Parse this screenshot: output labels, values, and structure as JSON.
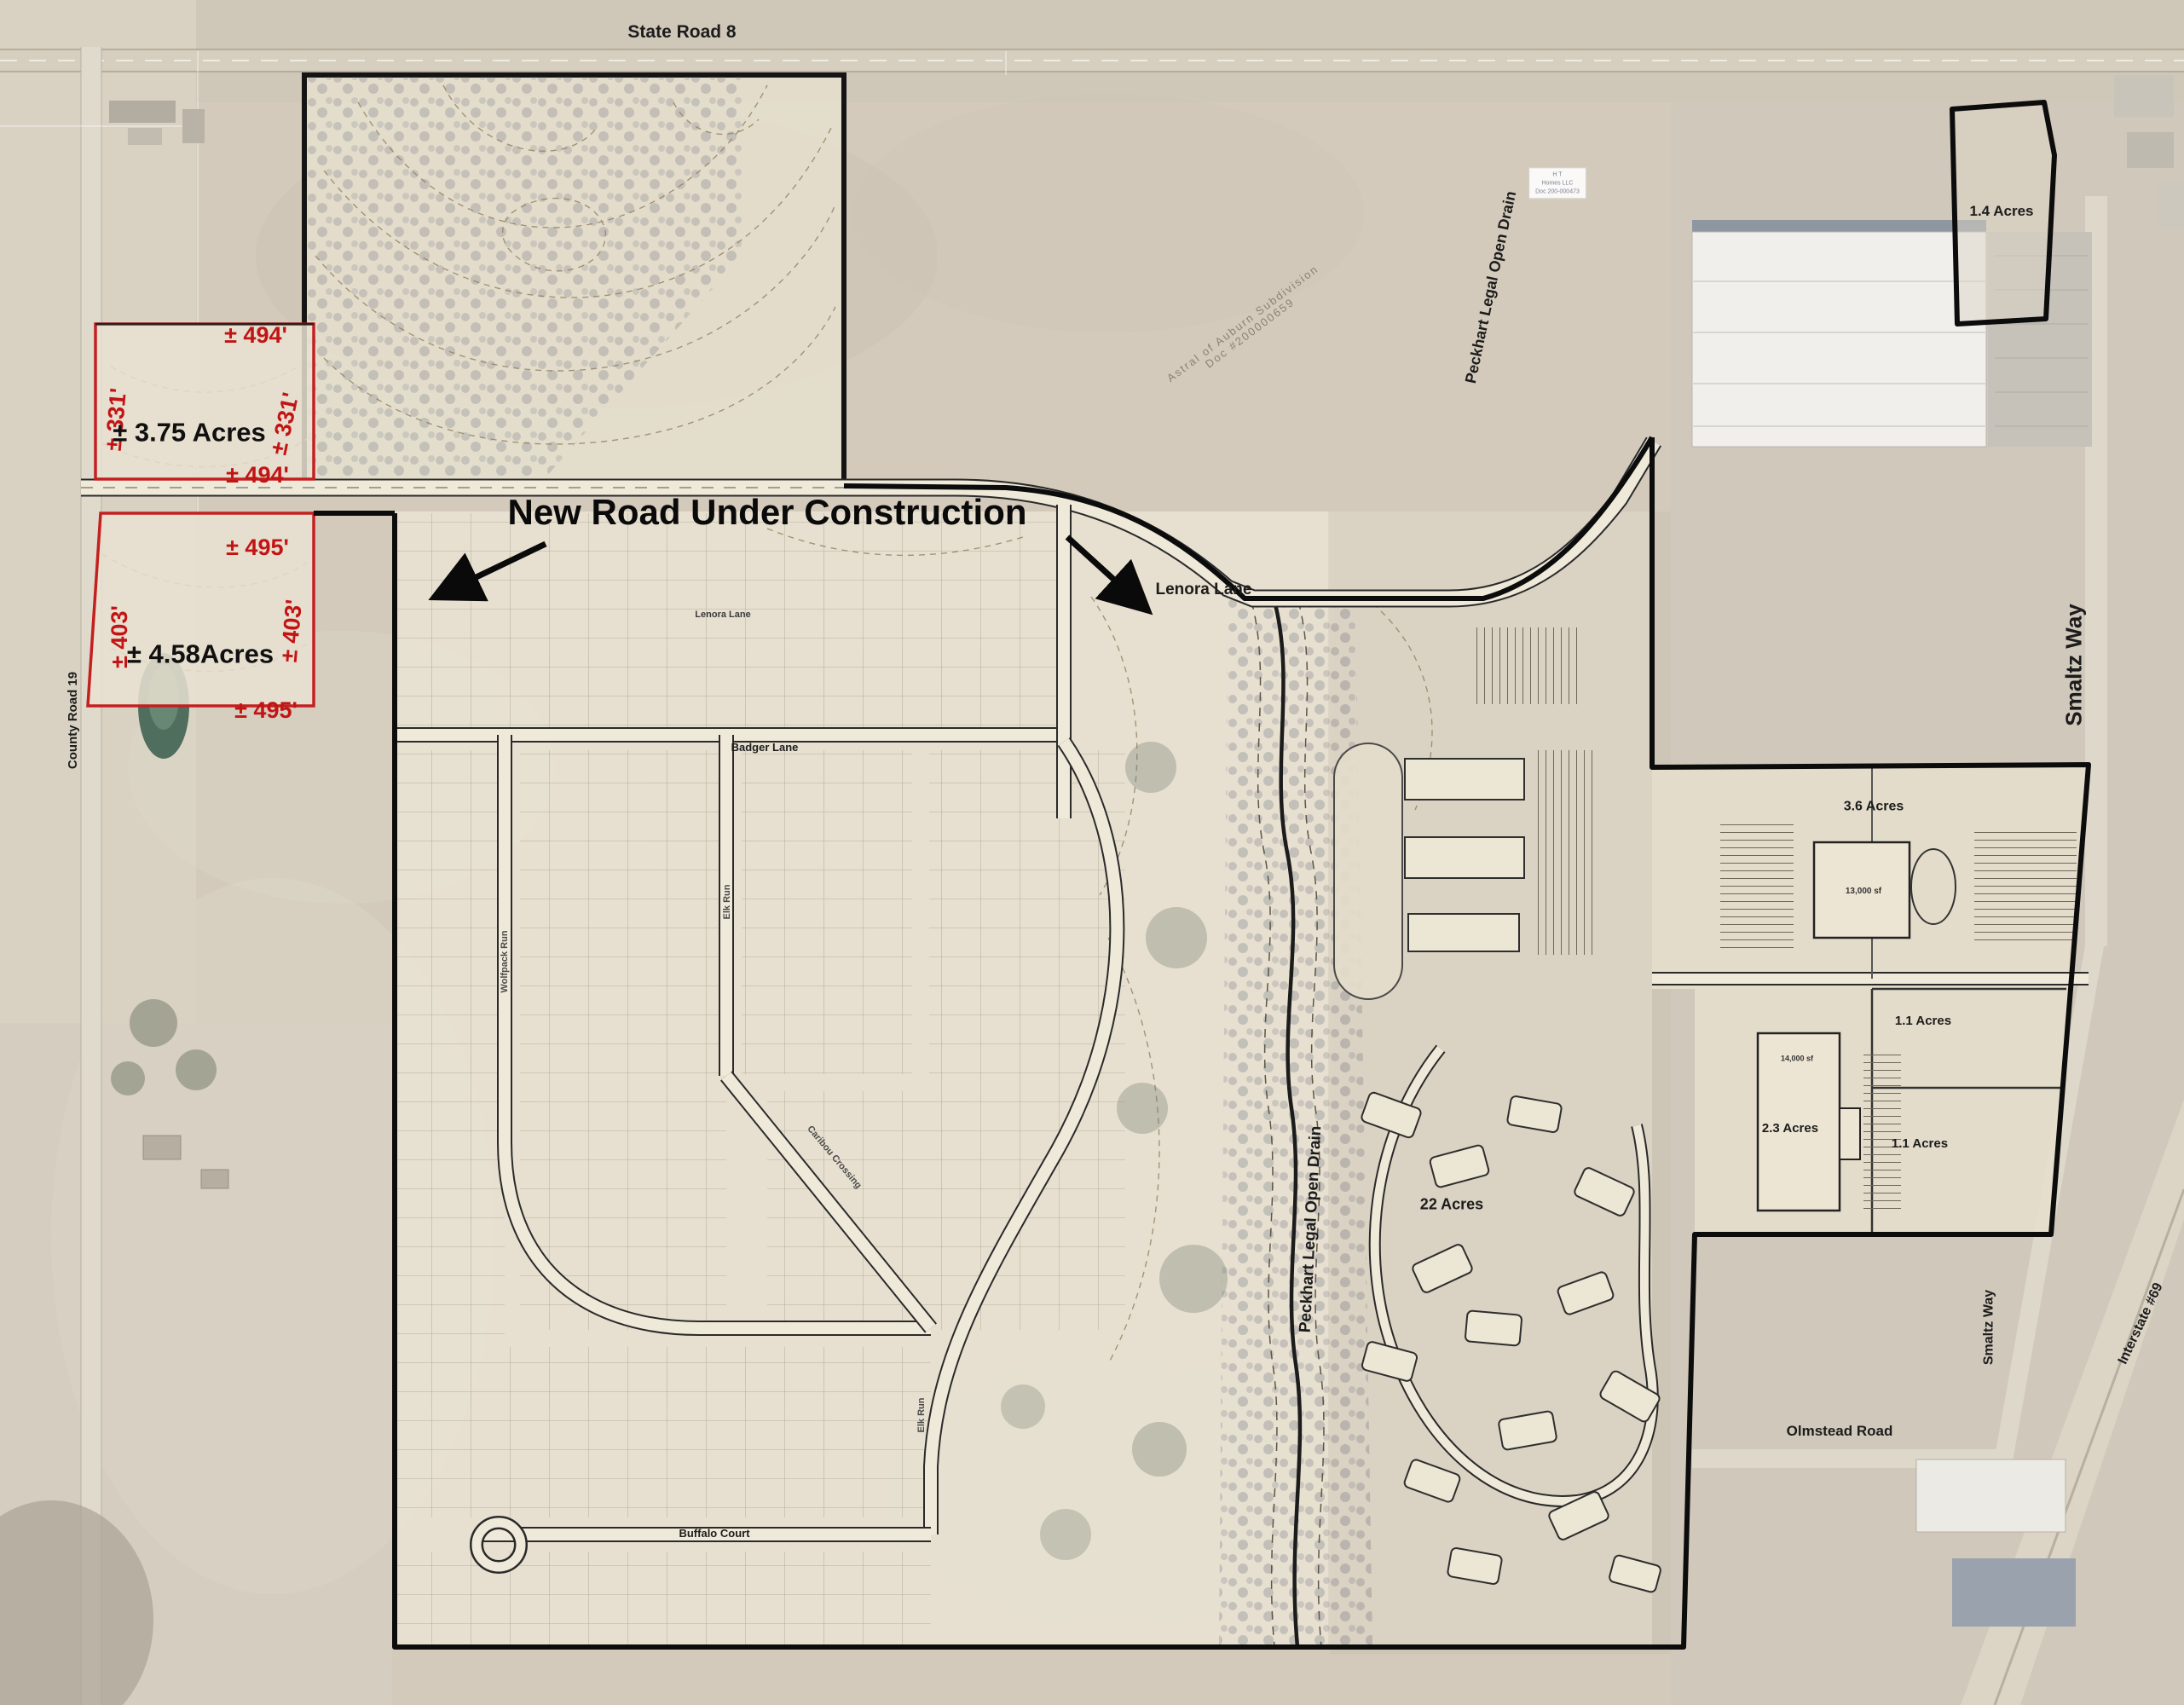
{
  "map": {
    "roads": {
      "state_road_8": "State Road 8",
      "county_road_19": "County Road 19",
      "lenora_lane_small": "Lenora Lane",
      "lenora_lane": "Lenora Lane",
      "badger_lane": "Badger Lane",
      "wolfpack_run": "Wolfpack Run",
      "elk_run_upper": "Elk Run",
      "caribou_crossing": "Caribou Crossing",
      "elk_run_lower": "Elk Run",
      "buffalo_court": "Buffalo Court",
      "smaltz_way_upper": "Smaltz Way",
      "smaltz_way_lower": "Smaltz Way",
      "olmstead_road": "Olmstead Road",
      "interstate_69": "Interstate #69"
    },
    "annotations": {
      "new_road": "New Road Under Construction",
      "drain_upper": "Peckhart Legal Open Drain",
      "drain_lower": "Peckhart Legal Open Drain",
      "astral_line1": "Astral of Auburn Subdivision",
      "astral_line2": "Doc #200000659",
      "owner_note": [
        "H T",
        "Homes LLC",
        "Doc 200-000473"
      ]
    },
    "parcels": {
      "p375": {
        "area": "± 3.75 Acres",
        "top": "± 494'",
        "bottom": "± 494'",
        "left": "± 331'",
        "right": "± 331'"
      },
      "p458": {
        "area": "± 4.58Acres",
        "top": "± 495'",
        "bottom": "± 495'",
        "left": "± 403'",
        "right": "± 403'"
      },
      "p14": "1.4 Acres",
      "p36": "3.6 Acres",
      "p11a": "1.1 Acres",
      "p23": "2.3 Acres",
      "p11b": "1.1 Acres",
      "p22": "22 Acres",
      "bldg13k": "13,000 sf",
      "bldg14k": "14,000 sf"
    },
    "colors": {
      "dimension_red": "#c21414",
      "boundary_black": "#0c0c0c",
      "parcel_red": "#c32020"
    }
  }
}
